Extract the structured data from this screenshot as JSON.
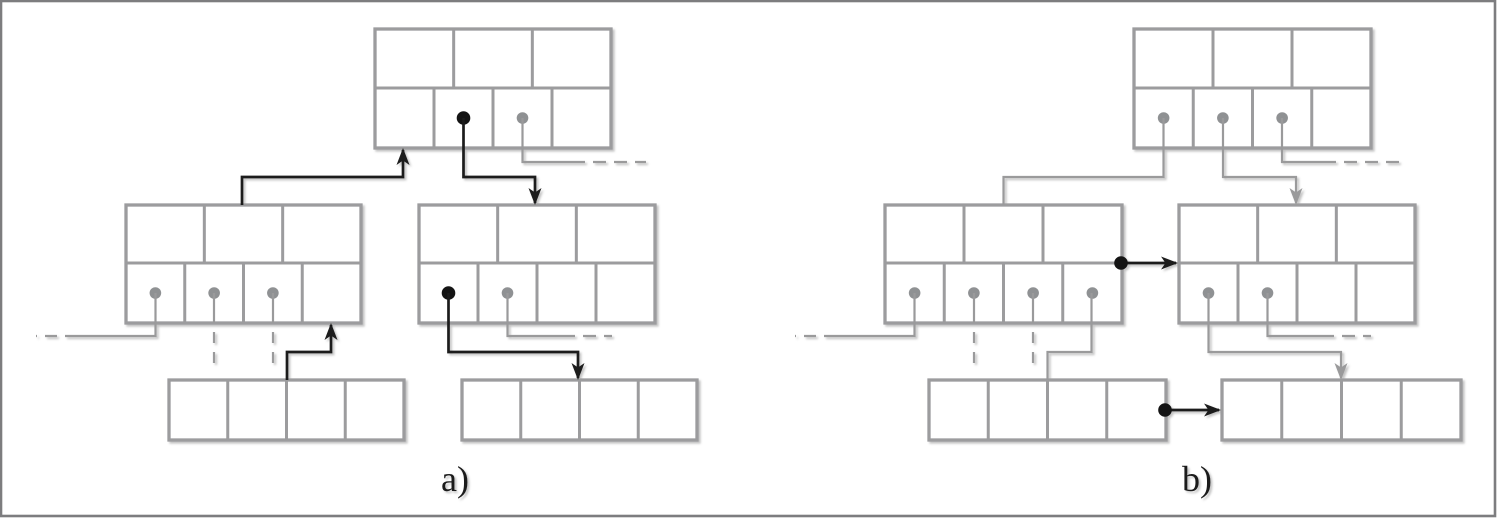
{
  "figure": {
    "title": "",
    "frame": {
      "x": 1,
      "y": 1,
      "width": 1494,
      "height": 515,
      "color": "#7d7d7f",
      "thickness": 2.6
    },
    "colors": {
      "node_border": "#9c9c9e",
      "gray_link": "#9a9a9b",
      "black_link": "#1c1c1c",
      "gray_dot": "#8f9193",
      "black_dot": "#141414",
      "background": "#ffffff"
    },
    "panels": [
      {
        "id": "a",
        "label": "a)",
        "label_x": 455,
        "label_y": 491,
        "nodes": [
          {
            "kind": "internal",
            "x": 375,
            "y": 29,
            "w": 236,
            "h": 119,
            "div": 59,
            "top_cells": 3,
            "bottom_cells": 4,
            "dots": [
              null,
              "black",
              "gray",
              null
            ]
          },
          {
            "kind": "internal",
            "x": 126,
            "y": 205,
            "w": 235,
            "h": 118,
            "div": 58,
            "top_cells": 3,
            "bottom_cells": 4,
            "dots": [
              "gray",
              "gray",
              "gray",
              null
            ]
          },
          {
            "kind": "internal",
            "x": 419,
            "y": 205,
            "w": 236,
            "h": 118,
            "div": 58,
            "top_cells": 3,
            "bottom_cells": 4,
            "dots": [
              "black",
              "gray",
              null,
              null
            ]
          },
          {
            "kind": "leaf",
            "x": 169,
            "y": 380,
            "w": 235,
            "h": 60,
            "cells": 4
          },
          {
            "kind": "leaf",
            "x": 462,
            "y": 380,
            "w": 235,
            "h": 60,
            "cells": 4
          }
        ],
        "links": [
          {
            "d": "M 242 205 V 177 H 403 V 150",
            "c": "black",
            "arrow": 1
          },
          {
            "d": "M 463.5 118 V 177 H 535 V 203",
            "c": "black",
            "arrow": 1
          },
          {
            "d": "M 522.5 118 V 162 H 572",
            "c": "gray"
          },
          {
            "d": "M 572 162 H 646",
            "c": "gray",
            "dash": "13 8"
          },
          {
            "d": "M 155.5 293 V 336 H 77",
            "c": "gray"
          },
          {
            "d": "M 77 336 H 36",
            "c": "gray",
            "dash": "12 8"
          },
          {
            "d": "M 214 293 V 323",
            "c": "gray"
          },
          {
            "d": "M 214 332 V 369",
            "c": "gray",
            "dash": "11 9"
          },
          {
            "d": "M 273 293 V 323",
            "c": "gray"
          },
          {
            "d": "M 273 332 V 369",
            "c": "gray",
            "dash": "11 9"
          },
          {
            "d": "M 287 380 V 352 H 331 V 325",
            "c": "black",
            "arrow": 1
          },
          {
            "d": "M 448.5 293 V 352 H 578 V 378",
            "c": "black",
            "arrow": 1
          },
          {
            "d": "M 507.5 293 V 336 H 562",
            "c": "gray"
          },
          {
            "d": "M 562 336 H 612",
            "c": "gray",
            "dash": "13 8"
          }
        ],
        "extra_dots": []
      },
      {
        "id": "b",
        "label": "b)",
        "label_x": 1197,
        "label_y": 491,
        "nodes": [
          {
            "kind": "internal",
            "x": 1134,
            "y": 29,
            "w": 237,
            "h": 119,
            "div": 59,
            "top_cells": 3,
            "bottom_cells": 4,
            "dots": [
              "gray",
              "gray",
              "gray",
              null
            ]
          },
          {
            "kind": "internal",
            "x": 885,
            "y": 205,
            "w": 237,
            "h": 118,
            "div": 58,
            "top_cells": 3,
            "bottom_cells": 4,
            "dots": [
              "gray",
              "gray",
              "gray",
              "gray"
            ]
          },
          {
            "kind": "internal",
            "x": 1179,
            "y": 205,
            "w": 236,
            "h": 118,
            "div": 58,
            "top_cells": 3,
            "bottom_cells": 4,
            "dots": [
              "gray",
              "gray",
              null,
              null
            ]
          },
          {
            "kind": "leaf",
            "x": 929,
            "y": 380,
            "w": 237,
            "h": 60,
            "cells": 4
          },
          {
            "kind": "leaf",
            "x": 1222,
            "y": 380,
            "w": 239,
            "h": 60,
            "cells": 4
          }
        ],
        "links": [
          {
            "d": "M 1163.5 118 V 177 H 1003.5 V 205",
            "c": "gray"
          },
          {
            "d": "M 1223 118 V 177 H 1296 V 203",
            "c": "gray",
            "arrow": 1
          },
          {
            "d": "M 1282 118 V 162 H 1323",
            "c": "gray"
          },
          {
            "d": "M 1323 162 H 1399",
            "c": "gray",
            "dash": "13 8"
          },
          {
            "d": "M 914.5 293 V 336 H 836",
            "c": "gray"
          },
          {
            "d": "M 836 336 H 795",
            "c": "gray",
            "dash": "12 8"
          },
          {
            "d": "M 974 293 V 323",
            "c": "gray"
          },
          {
            "d": "M 974 332 V 369",
            "c": "gray",
            "dash": "11 9"
          },
          {
            "d": "M 1033 293 V 323",
            "c": "gray"
          },
          {
            "d": "M 1033 332 V 369",
            "c": "gray",
            "dash": "11 9"
          },
          {
            "d": "M 1091.5 293 V 352 H 1047.5 V 380",
            "c": "gray"
          },
          {
            "d": "M 1208.5 293 V 352 H 1341 V 378",
            "c": "gray",
            "arrow": 1
          },
          {
            "d": "M 1267.5 293 V 336 H 1321",
            "c": "gray"
          },
          {
            "d": "M 1321 336 H 1371",
            "c": "gray",
            "dash": "13 8"
          },
          {
            "d": "M 1121 263 H 1176",
            "c": "black",
            "arrow": 1
          },
          {
            "d": "M 1165 410 H 1219",
            "c": "black",
            "arrow": 1
          }
        ],
        "extra_dots": [
          {
            "x": 1121,
            "y": 263,
            "color": "black"
          },
          {
            "x": 1165,
            "y": 410,
            "color": "black"
          }
        ]
      }
    ]
  }
}
